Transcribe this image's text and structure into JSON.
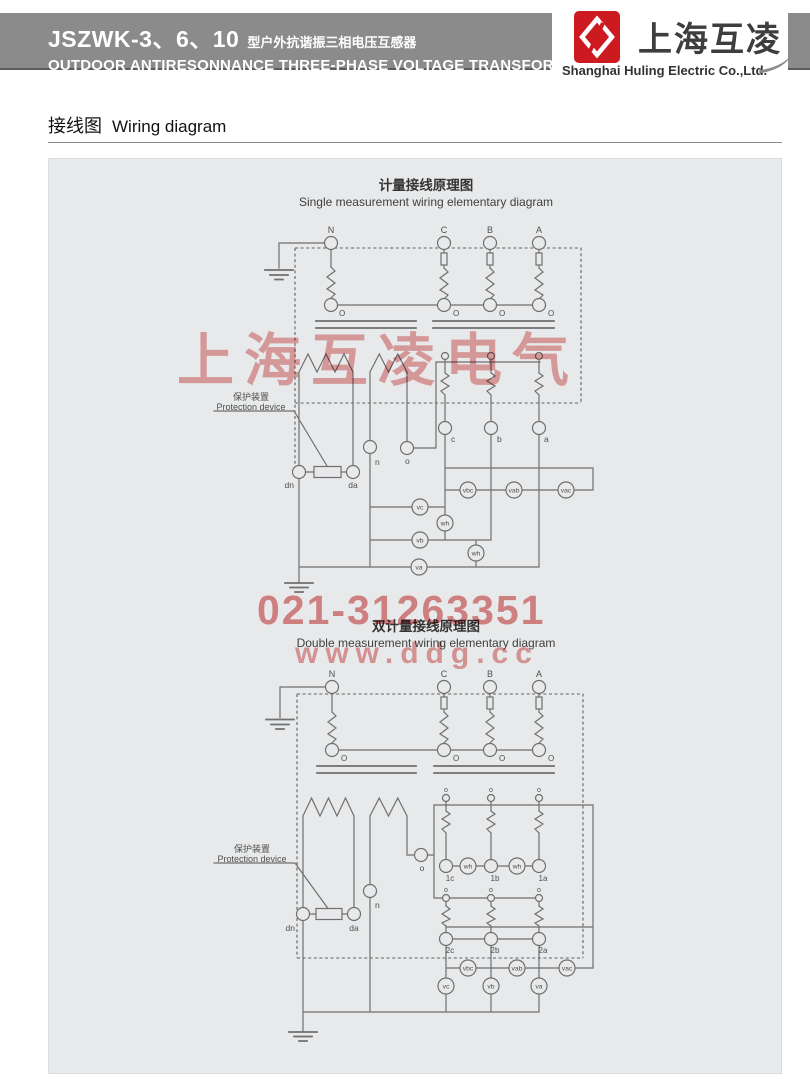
{
  "header": {
    "model": "JSZWK-3、6、10",
    "model_desc": "型户外抗谐振三相电压互感器",
    "subtitle_en": "OUTDOOR ANTIRESONNANCE THREE-PHASE VOLTAGE TRANSFORMER",
    "brand_cn": "上海互凌",
    "brand_en": "Shanghai Huling Electric Co.,Ltd."
  },
  "section": {
    "title_cn": "接线图",
    "title_en": "Wiring diagram"
  },
  "watermark": {
    "brand": "上海互凌电气",
    "phone": "021-31263351",
    "website": "www.ddg.cc"
  },
  "colors": {
    "header_gray": "#8b8b8b",
    "logo_red": "#cc1a20",
    "watermark_red": "#d95f5f",
    "diagram_bg": "#e8e9ea",
    "line_gray": "#6f6f6f"
  },
  "d1": {
    "title_cn": "计量接线原理图",
    "title_en": "Single measurement wiring elementary diagram",
    "N": "N",
    "C": "C",
    "B": "B",
    "A": "A",
    "O": "O",
    "c": "c",
    "b": "b",
    "a": "a",
    "n": "n",
    "o": "o",
    "dn": "dn",
    "da": "da",
    "prot_cn": "保护装置",
    "prot_en": "Protection device",
    "vc": "vc",
    "vb": "vb",
    "va": "va",
    "wh": "wh",
    "vbc": "vbc",
    "vab": "vab",
    "vac": "vac"
  },
  "d2": {
    "title_cn": "双计量接线原理图",
    "title_en": "Double measurement wiring elementary diagram",
    "N": "N",
    "C": "C",
    "B": "B",
    "A": "A",
    "O": "O",
    "o": "o",
    "n": "n",
    "dn": "dn",
    "da": "da",
    "prot_cn": "保护装置",
    "prot_en": "Protection device",
    "wh": "wh",
    "c1": "1c",
    "b1": "1b",
    "a1": "1a",
    "c2": "2c",
    "b2": "2b",
    "a2": "2a",
    "vbc": "vbc",
    "vab": "vab",
    "vac": "vac",
    "vc": "vc",
    "vb": "vb",
    "va": "va"
  }
}
